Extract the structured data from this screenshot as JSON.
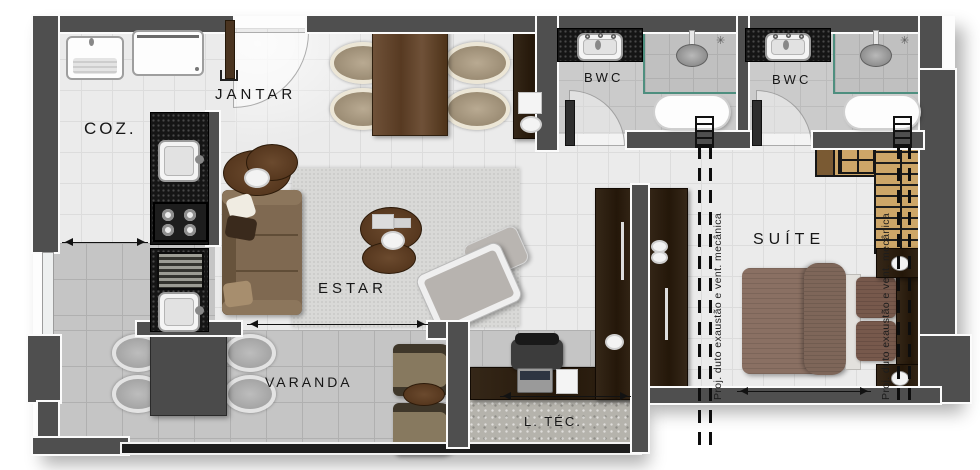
{
  "title": "apartment-floor-plan",
  "rooms": {
    "jantar": "JANTAR",
    "coz": "COZ.",
    "estar": "ESTAR",
    "varanda": "VARANDA",
    "bwc_1": "BWC",
    "bwc_2": "BWC",
    "suite": "SUÍTE",
    "ltec": "L. TÉC."
  },
  "annotations": {
    "duct_1": "Proj. duto exaustão e vent. mecânica",
    "duct_2": "Proj. duto exaustão e vent. mecânica"
  },
  "icons": {
    "vent_1": "✳",
    "vent_2": "✳"
  },
  "colors": {
    "wall": "#4f4f4f",
    "floor_light": "#ebebeb",
    "floor_varanda": "#c5c5c5",
    "floor_bwc": "#cbcbcb",
    "counter_dark": "#151515",
    "wood_medium": "#6a4c33",
    "wood_dark": "#2e2118",
    "wood_light": "#cda668",
    "shower_glass": "#4e8f7f",
    "bed_blanket": "#8a7063",
    "railing": "#1d1d1d"
  }
}
